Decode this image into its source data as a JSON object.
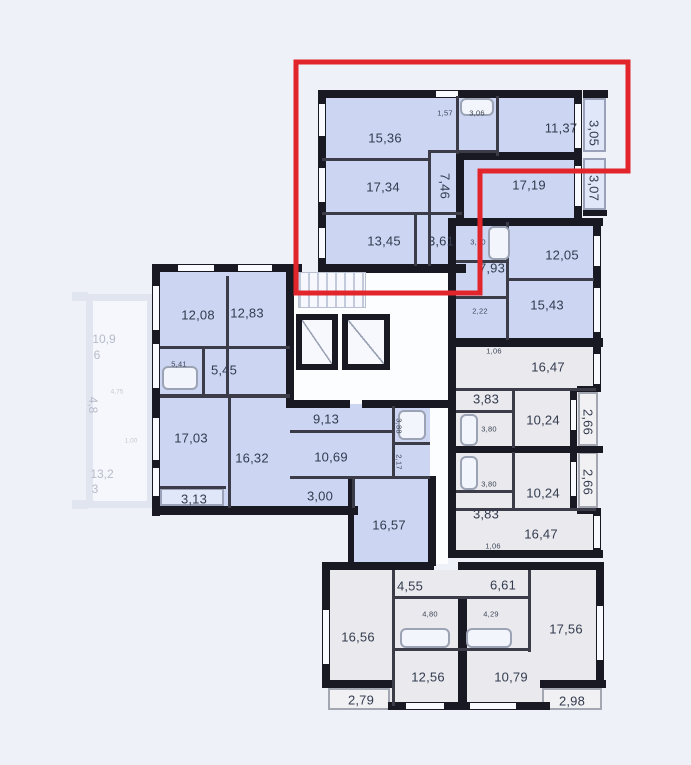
{
  "colors": {
    "highlight": "#e2242b",
    "wall": "#191923",
    "room_blue": "#ccd6f3",
    "room_gray": "#eaeaee",
    "background": "#eef1f8"
  },
  "highlighted_apartment": {
    "room_15_36": "15,36",
    "room_17_34": "17,34",
    "room_13_45": "13,45",
    "hall_3_61": "3,61",
    "corridor_7_46": "7,46",
    "wc_1_57": "1,57",
    "bath_3_06": "3,06",
    "room_11_37": "11,37",
    "balcony_3_05": "3,05",
    "room_17_19": "17,19",
    "balcony_3_07": "3,07"
  },
  "right_apartment": {
    "bath_3_10": "3,10",
    "room_12_05": "12,05",
    "hall_7_93": "7,93",
    "corridor_2_22": "2,22",
    "room_15_43": "15,43"
  },
  "left_apartment": {
    "room_12_08": "12,08",
    "room_12_83": "12,83",
    "bath_5_41": "5,41",
    "hall_5_45": "5,45",
    "room_17_03": "17,03",
    "room_16_32": "16,32",
    "hall_9_13": "9,13",
    "room_10_69": "10,69",
    "bath_3_88": "3,88",
    "wc_2_17": "2,17",
    "balcony_3_13": "3,13",
    "corridor_3_00": "3,00",
    "room_16_57": "16,57"
  },
  "mid_gray_apartments": {
    "hall_1_06_upper": "1,06",
    "room_16_47_upper": "16,47",
    "hall_3_83_upper": "3,83",
    "bath_3_80_upper": "3,80",
    "room_10_24_upper": "10,24",
    "balcony_2_66_upper": "2,66",
    "bath_3_80_lower": "3,80",
    "room_10_24_lower": "10,24",
    "balcony_2_66_lower": "2,66",
    "hall_3_83_lower": "3,83",
    "room_16_47_lower": "16,47",
    "hall_1_06_lower": "1,06"
  },
  "bottom_apartments": {
    "hall_4_55": "4,55",
    "hall_6_61": "6,61",
    "bath_4_80": "4,80",
    "bath_4_29": "4,29",
    "room_16_56": "16,56",
    "room_12_56": "12,56",
    "room_10_79": "10,79",
    "room_17_56": "17,56",
    "balcony_2_79": "2,79",
    "balcony_2_98": "2,98"
  },
  "adjacent_section": {
    "area_10_9": "10,9",
    "floor_6": "6",
    "dim_4_75": "4,75",
    "area_4_8": "4,8",
    "dim_1_00": "1,00",
    "area_13_2": "13,2",
    "floor_3": "3"
  }
}
